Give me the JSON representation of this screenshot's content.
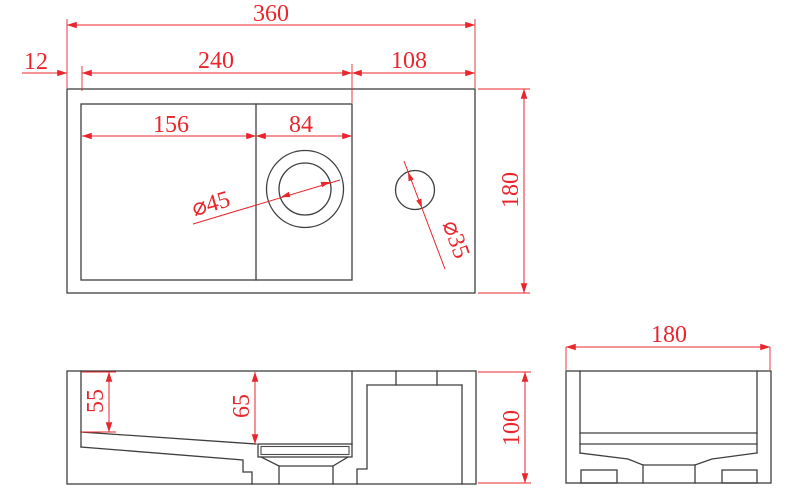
{
  "drawing": {
    "type": "technical-dimension-drawing",
    "views": {
      "top": {
        "name": "top view (plan)",
        "dims": {
          "overall_width": "360",
          "left_wall_offset": "12",
          "basin_opening_width": "240",
          "deck_width": "108",
          "bowl_left_section": "156",
          "bowl_right_section": "84",
          "drain_diameter": "⌀45",
          "faucet_hole_diameter": "⌀35",
          "overall_depth": "180"
        }
      },
      "front": {
        "name": "front section view",
        "dims": {
          "bowl_depth_left": "55",
          "bowl_depth_at_drain": "65",
          "overall_height": "100"
        }
      },
      "side": {
        "name": "side section view",
        "dims": {
          "overall_depth": "180"
        }
      }
    },
    "colors": {
      "dimension_red": "#e8262c",
      "outline_black": "#3f3f3f",
      "background": "#ffffff"
    }
  }
}
